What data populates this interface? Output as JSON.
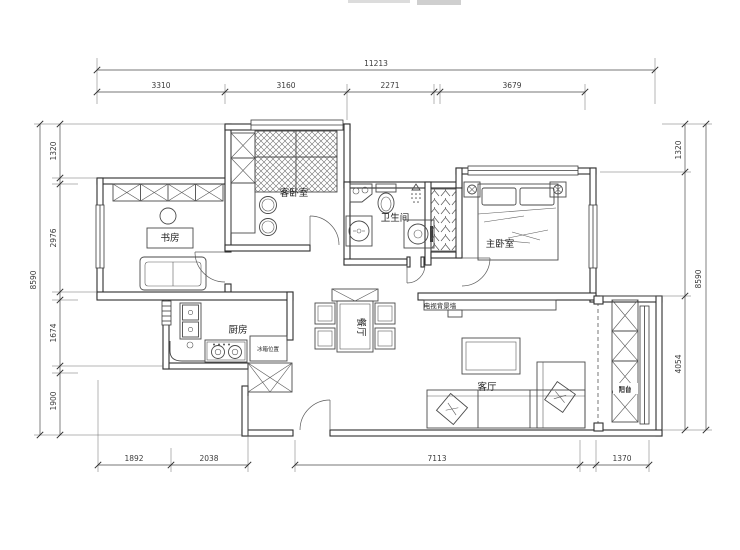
{
  "colors": {
    "background": "#ffffff",
    "line": "#2f2f2f",
    "dim": "#3c3c3c"
  },
  "rooms": {
    "study": "书房",
    "guest_bedroom": "客卧室",
    "bathroom": "卫生间",
    "master_bedroom": "主卧室",
    "kitchen": "厨房",
    "dining": "餐厅",
    "living": "客厅",
    "balcony": "阳台"
  },
  "annotations": {
    "tv_wall": "电视背景墙",
    "fridge": "冰箱位置"
  },
  "dimensions": {
    "top": {
      "overall": "11213",
      "segments": [
        "3310",
        "3160",
        "2271",
        "3679"
      ]
    },
    "left": {
      "overall": "8590",
      "segments": [
        "1320",
        "2976",
        "1674",
        "1900"
      ]
    },
    "right": {
      "overall": "8590",
      "segments": [
        "1320",
        "4054"
      ]
    },
    "bottom": {
      "segments": [
        "1892",
        "2038",
        "7113",
        "1370"
      ]
    }
  }
}
